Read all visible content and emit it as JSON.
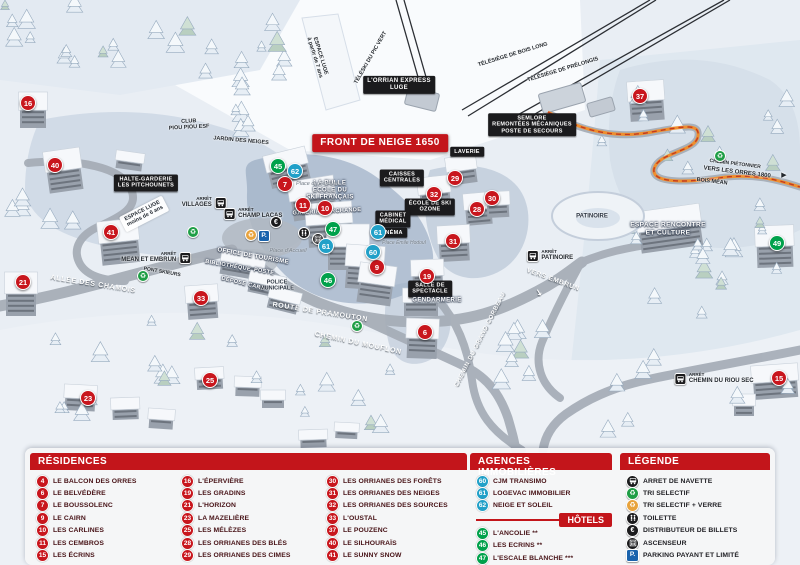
{
  "colors": {
    "residence": "#c8161d",
    "hotel": "#00a14b",
    "agency": "#21a0c8",
    "header": "#c3151b",
    "parking": "#1a63ad",
    "verre": "#e8a33d",
    "dark_icon": "#1b1b1d",
    "path_orange": "#ef8f2e"
  },
  "map": {
    "banner": "FRONT DE NEIGE 1650",
    "stop_word": "ARRÊT",
    "labels": [
      {
        "t": "FRONT DE NEIGE 1650",
        "x": 380,
        "y": 143,
        "s": "banner"
      },
      {
        "t": "L'ORRIAN EXPRESS|LUGE",
        "x": 399,
        "y": 85,
        "s": "box",
        "fs": 6
      },
      {
        "t": "SEMLORE|REMONTÉES MÉCANIQUES|POSTE DE SECOURS",
        "x": 532,
        "y": 125,
        "s": "box",
        "fs": 5.5
      },
      {
        "t": "LAVERIE",
        "x": 467,
        "y": 152,
        "s": "box"
      },
      {
        "t": "CAISSES|CENTRALES",
        "x": 402,
        "y": 178,
        "s": "box"
      },
      {
        "t": "HALTE-GARDERIE|LES PITCHOUNETS",
        "x": 146,
        "y": 183,
        "s": "box"
      },
      {
        "t": "ÉCOLE DE SKI|OZONE",
        "x": 430,
        "y": 207,
        "s": "box"
      },
      {
        "t": "CABINET|MÉDICAL",
        "x": 393,
        "y": 219,
        "s": "box"
      },
      {
        "t": "CINÉMA",
        "x": 391,
        "y": 233,
        "s": "box"
      },
      {
        "t": "SALLE DE|SPECTACLE",
        "x": 430,
        "y": 289,
        "s": "box"
      },
      {
        "t": "LA BULLE|ÉCOLE DU|SKI FRANÇAIS",
        "x": 330,
        "y": 191,
        "s": "white"
      },
      {
        "t": "GALERIE MARCHANDE",
        "x": 327,
        "y": 212,
        "s": "white",
        "r": -3,
        "fs": 5.5
      },
      {
        "t": "OFFICE DE TOURISME",
        "x": 253,
        "y": 257,
        "s": "white",
        "r": 10
      },
      {
        "t": "BIBLIOTHÈQUE",
        "x": 228,
        "y": 266,
        "s": "white",
        "r": 10,
        "fs": 5.5
      },
      {
        "t": "POSTE",
        "x": 264,
        "y": 272,
        "s": "white",
        "r": 10,
        "fs": 5.5
      },
      {
        "t": "DÉPOSE CARS",
        "x": 243,
        "y": 284,
        "s": "white",
        "r": 14,
        "fs": 5.5
      },
      {
        "t": "POLICE|MUNICIPALE",
        "x": 277,
        "y": 286,
        "s": "navy"
      },
      {
        "t": "GENDARMERIE",
        "x": 437,
        "y": 301,
        "s": "white"
      },
      {
        "t": "ESPACE RENCONTRE|ET CULTURE",
        "x": 668,
        "y": 229,
        "s": "white",
        "fs": 6.5
      },
      {
        "t": "PATINOIRE",
        "x": 592,
        "y": 217,
        "s": "navy",
        "fs": 6
      },
      {
        "t": "CLUB|PIOU PIOU ESF",
        "x": 189,
        "y": 125,
        "s": "dark",
        "r": -3
      },
      {
        "t": "JARDIN DES NEIGES",
        "x": 241,
        "y": 141,
        "s": "dark",
        "r": 5
      },
      {
        "t": "ESPACE LUGE|moins de 6 ans",
        "x": 144,
        "y": 214,
        "s": "chip",
        "r": -27
      },
      {
        "t": "ESPACE LUGE|à partir de 7 ans",
        "x": 317,
        "y": 57,
        "s": "dark",
        "r": 73
      },
      {
        "t": "TÉLÉSKI DU PIC VERT",
        "x": 371,
        "y": 58,
        "s": "dark",
        "r": -60
      },
      {
        "t": "TÉLÉSIÈGE DE BOIS LONG",
        "x": 513,
        "y": 55,
        "s": "dark",
        "r": -17
      },
      {
        "t": "TÉLÉSIÈGE DE PRÉLONGIS",
        "x": 563,
        "y": 70,
        "s": "dark",
        "r": -17
      },
      {
        "t": "ALLÉE DES CHAMOIS",
        "x": 93,
        "y": 285,
        "s": "road",
        "r": 9
      },
      {
        "t": "ROUTE DE PRAMOUTON",
        "x": 320,
        "y": 313,
        "s": "road",
        "r": 9
      },
      {
        "t": "CHEMIN DU MOUFLON",
        "x": 358,
        "y": 344,
        "s": "road",
        "r": 12
      },
      {
        "t": "CHEMIN DU GRAND CORBEAU",
        "x": 481,
        "y": 340,
        "s": "road",
        "r": -63,
        "fs": 6
      },
      {
        "t": "VERS EMBRUN",
        "x": 553,
        "y": 280,
        "s": "road",
        "r": 20,
        "fs": 6.5
      },
      {
        "t": "↘",
        "x": 539,
        "y": 293,
        "s": "road",
        "r": 15,
        "fs": 9
      },
      {
        "t": "CHEMIN PIÉTONNIER",
        "x": 735,
        "y": 165,
        "s": "dark",
        "r": 7,
        "fs": 5
      },
      {
        "t": "VERS LES ORRES 1800",
        "x": 737,
        "y": 173,
        "s": "dark",
        "r": 7,
        "fs": 6
      },
      {
        "t": "BOIS MÉAN",
        "x": 712,
        "y": 182,
        "s": "dark",
        "r": 7,
        "fs": 5.5
      },
      {
        "t": "▶",
        "x": 784,
        "y": 176,
        "s": "dark",
        "fs": 7
      },
      {
        "t": "PONT SKIEURS",
        "x": 162,
        "y": 273,
        "s": "dark",
        "r": 10,
        "fs": 5
      },
      {
        "t": "Place du Festival",
        "x": 317,
        "y": 184,
        "s": "place"
      },
      {
        "t": "Place d'Accueil",
        "x": 288,
        "y": 251,
        "s": "place"
      },
      {
        "t": "Place Émile Hodoul",
        "x": 404,
        "y": 244,
        "s": "place",
        "fs": 5
      }
    ],
    "stops": [
      {
        "name": "VILLAGES",
        "x": 204,
        "y": 203,
        "side": "right"
      },
      {
        "name": "CHAMP LACAS",
        "x": 253,
        "y": 214,
        "side": "left"
      },
      {
        "name": "MEAN ET EMBRUN",
        "x": 156,
        "y": 258,
        "side": "right"
      },
      {
        "name": "PATINOIRE",
        "x": 550,
        "y": 256,
        "side": "left"
      },
      {
        "name": "CHEMIN DU RIOU SEC",
        "x": 714,
        "y": 379,
        "side": "left"
      }
    ],
    "icons": [
      {
        "k": "recycle",
        "x": 193,
        "y": 232
      },
      {
        "k": "recycle",
        "x": 143,
        "y": 276
      },
      {
        "k": "recycle",
        "x": 357,
        "y": 326
      },
      {
        "k": "recycle",
        "x": 720,
        "y": 156
      },
      {
        "k": "verre",
        "x": 251,
        "y": 235
      },
      {
        "k": "park",
        "x": 264,
        "y": 236
      },
      {
        "k": "euro",
        "x": 276,
        "y": 222
      },
      {
        "k": "wc",
        "x": 304,
        "y": 233
      },
      {
        "k": "lift",
        "x": 318,
        "y": 239
      }
    ],
    "markers": [
      {
        "n": "16",
        "t": "res",
        "x": 28,
        "y": 103
      },
      {
        "n": "40",
        "t": "res",
        "x": 55,
        "y": 165
      },
      {
        "n": "41",
        "t": "res",
        "x": 111,
        "y": 232
      },
      {
        "n": "21",
        "t": "res",
        "x": 23,
        "y": 282
      },
      {
        "n": "33",
        "t": "res",
        "x": 201,
        "y": 298
      },
      {
        "n": "23",
        "t": "res",
        "x": 88,
        "y": 398
      },
      {
        "n": "25",
        "t": "res",
        "x": 210,
        "y": 380
      },
      {
        "n": "7",
        "t": "res",
        "x": 285,
        "y": 184
      },
      {
        "n": "11",
        "t": "res",
        "x": 303,
        "y": 205
      },
      {
        "n": "10",
        "t": "res",
        "x": 325,
        "y": 208
      },
      {
        "n": "9",
        "t": "res",
        "x": 377,
        "y": 267
      },
      {
        "n": "32",
        "t": "res",
        "x": 434,
        "y": 194
      },
      {
        "n": "29",
        "t": "res",
        "x": 455,
        "y": 178
      },
      {
        "n": "28",
        "t": "res",
        "x": 477,
        "y": 209
      },
      {
        "n": "30",
        "t": "res",
        "x": 492,
        "y": 198
      },
      {
        "n": "31",
        "t": "res",
        "x": 453,
        "y": 241
      },
      {
        "n": "19",
        "t": "res",
        "x": 427,
        "y": 276
      },
      {
        "n": "6",
        "t": "res",
        "x": 425,
        "y": 332
      },
      {
        "n": "37",
        "t": "res",
        "x": 640,
        "y": 96
      },
      {
        "n": "15",
        "t": "res",
        "x": 779,
        "y": 378
      },
      {
        "n": "45",
        "t": "hot",
        "x": 278,
        "y": 166
      },
      {
        "n": "47",
        "t": "hot",
        "x": 333,
        "y": 229
      },
      {
        "n": "46",
        "t": "hot",
        "x": 328,
        "y": 280
      },
      {
        "n": "49",
        "t": "hot",
        "x": 777,
        "y": 243
      },
      {
        "n": "62",
        "t": "agc",
        "x": 295,
        "y": 171
      },
      {
        "n": "61",
        "t": "agc",
        "x": 326,
        "y": 246
      },
      {
        "n": "61",
        "t": "agc",
        "x": 378,
        "y": 232
      },
      {
        "n": "60",
        "t": "agc",
        "x": 373,
        "y": 252
      }
    ]
  },
  "panel": {
    "residences": {
      "title": "RÉSIDENCES",
      "columns": [
        [
          {
            "n": "4",
            "label": "LE BALCON DES ORRES"
          },
          {
            "n": "6",
            "label": "LE BELVÉDÈRE"
          },
          {
            "n": "7",
            "label": "LE BOUSSOLENC"
          },
          {
            "n": "9",
            "label": "LE CAIRN"
          },
          {
            "n": "10",
            "label": "LES CARLINES"
          },
          {
            "n": "11",
            "label": "LES CEMBROS"
          },
          {
            "n": "15",
            "label": "LES ÉCRINS"
          }
        ],
        [
          {
            "n": "16",
            "label": "L'ÉPERVIÈRE"
          },
          {
            "n": "19",
            "label": "LES GRADINS"
          },
          {
            "n": "21",
            "label": "L'HORIZON"
          },
          {
            "n": "23",
            "label": "LA MAZELIÈRE"
          },
          {
            "n": "25",
            "label": "LES MÉLÈZES"
          },
          {
            "n": "28",
            "label": "LES ORRIANES DES BLÉS"
          },
          {
            "n": "29",
            "label": "LES ORRIANES DES CIMES"
          }
        ],
        [
          {
            "n": "30",
            "label": "LES ORRIANES DES FORÊTS"
          },
          {
            "n": "31",
            "label": "LES ORRIANES DES NEIGES"
          },
          {
            "n": "32",
            "label": "LES ORRIANES DES SOURCES"
          },
          {
            "n": "33",
            "label": "L'OUSTAL"
          },
          {
            "n": "37",
            "label": "LE POUZENC"
          },
          {
            "n": "40",
            "label": "LE SILHOURAÏS"
          },
          {
            "n": "41",
            "label": "LE SUNNY SNOW"
          }
        ]
      ]
    },
    "agencies": {
      "title": "AGENCES IMMOBILIÈRES",
      "items": [
        {
          "n": "60",
          "label": "CJM TRANSIMO"
        },
        {
          "n": "61",
          "label": "LOGEVAC IMMOBILIER"
        },
        {
          "n": "62",
          "label": "NEIGE ET SOLEIL"
        }
      ]
    },
    "hotels": {
      "title": "HÔTELS",
      "items": [
        {
          "n": "45",
          "label": "L'ANCOLIE **"
        },
        {
          "n": "46",
          "label": "LES ECRINS **"
        },
        {
          "n": "47",
          "label": "L'ESCALE BLANCHE ***"
        },
        {
          "n": "49",
          "label": "LES TRAPPEURS **"
        }
      ]
    },
    "legend": {
      "title": "LÉGENDE",
      "items": [
        {
          "icon": "navette",
          "label": "ARRET DE NAVETTE"
        },
        {
          "icon": "recycle",
          "label": "TRI SELECTIF"
        },
        {
          "icon": "verre",
          "label": "TRI SELECTIF + VERRE"
        },
        {
          "icon": "wc",
          "label": "TOILETTE"
        },
        {
          "icon": "euro",
          "label": "DISTRIBUTEUR DE BILLETS"
        },
        {
          "icon": "lift",
          "label": "ASCENSEUR"
        },
        {
          "icon": "park",
          "label": "PARKING PAYANT ET LIMITÉ"
        }
      ]
    }
  }
}
